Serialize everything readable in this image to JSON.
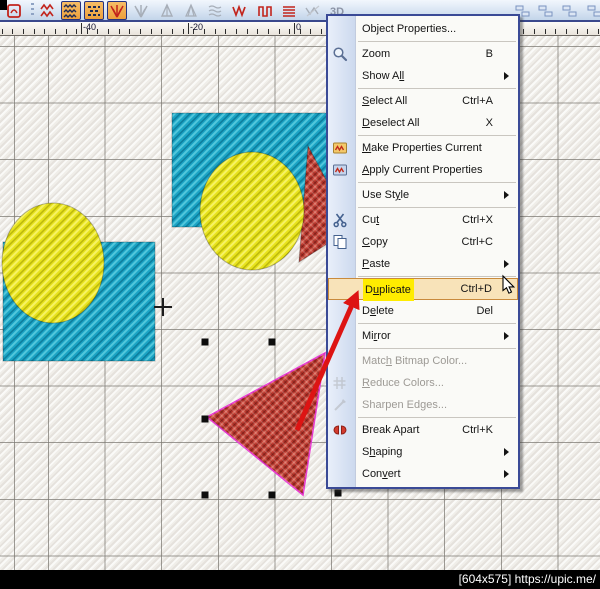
{
  "window": {
    "watermark": "[604x575] https://upic.me/"
  },
  "toolbar": {
    "icons": [
      {
        "name": "motif-stamp-icon",
        "glyph": "motif",
        "x": 4,
        "pressed": false,
        "disabled": false
      },
      {
        "name": "toolbar-separator",
        "glyph": "sep",
        "x": 31
      },
      {
        "name": "stitch-zigzag-icon",
        "glyph": "zzred",
        "x": 38,
        "pressed": false,
        "disabled": false
      },
      {
        "name": "tatami-fill-icon",
        "glyph": "tatami",
        "x": 61,
        "pressed": true,
        "disabled": false
      },
      {
        "name": "motif-fill-icon",
        "glyph": "dots",
        "x": 84,
        "pressed": true,
        "disabled": false
      },
      {
        "name": "fancy-fill-icon",
        "glyph": "burstred",
        "x": 107,
        "pressed": true,
        "disabled": false
      },
      {
        "name": "radial-fill-icon",
        "glyph": "burstgray",
        "x": 131,
        "pressed": false,
        "disabled": true
      },
      {
        "name": "fur-effect-icon",
        "glyph": "tree",
        "x": 157,
        "pressed": false,
        "disabled": true
      },
      {
        "name": "feather-edge-icon",
        "glyph": "tree2",
        "x": 181,
        "pressed": false,
        "disabled": true
      },
      {
        "name": "ripple-effect-icon",
        "glyph": "ripple",
        "x": 205,
        "pressed": false,
        "disabled": true
      },
      {
        "name": "zigzag-stitch-icon",
        "glyph": "zzw",
        "x": 230,
        "pressed": false,
        "disabled": false
      },
      {
        "name": "step-stitch-icon",
        "glyph": "pipe",
        "x": 255,
        "pressed": false,
        "disabled": false
      },
      {
        "name": "satin-stitch-icon",
        "glyph": "lines",
        "x": 279,
        "pressed": false,
        "disabled": false
      },
      {
        "name": "texture-hatch-icon",
        "glyph": "hatch",
        "x": 303,
        "pressed": false,
        "disabled": true
      },
      {
        "name": "3d-effect-button",
        "glyph": "text3d",
        "x": 327,
        "pressed": false,
        "disabled": true,
        "label": "3D"
      },
      {
        "name": "align-tool-icon",
        "glyph": "align",
        "x": 513,
        "pressed": false,
        "disabled": false
      },
      {
        "name": "distribute-tool-icon",
        "glyph": "align",
        "x": 536,
        "pressed": false,
        "disabled": false
      },
      {
        "name": "spacing-tool-icon",
        "glyph": "align",
        "x": 560,
        "pressed": false,
        "disabled": false
      },
      {
        "name": "group-tool-icon",
        "glyph": "align",
        "x": 585,
        "pressed": false,
        "disabled": false
      }
    ]
  },
  "ruler": {
    "labels": [
      {
        "text": "-40",
        "x": 83
      },
      {
        "text": "-20",
        "x": 190
      },
      {
        "text": "0",
        "x": 296
      }
    ],
    "major_tick_x": [
      81,
      187.6,
      294.2,
      400.8,
      507.4
    ],
    "minor_step": 10.65
  },
  "context_menu": {
    "items": [
      {
        "label": "Object Properties...",
        "mnemonic": -1,
        "mlen": 1,
        "shortcut": "",
        "icon": null,
        "submenu": false,
        "disabled": false,
        "highlighted": false,
        "marked": false
      },
      {
        "type": "separator"
      },
      {
        "label": "Zoom",
        "mnemonic": -1,
        "mlen": 1,
        "shortcut": "B",
        "icon": "zoom",
        "submenu": false,
        "disabled": false,
        "highlighted": false,
        "marked": false
      },
      {
        "label": "Show All",
        "mnemonic": 6,
        "mlen": 2,
        "shortcut": "",
        "icon": null,
        "submenu": true,
        "disabled": false,
        "highlighted": false,
        "marked": false
      },
      {
        "type": "separator"
      },
      {
        "label": "Select All",
        "mnemonic": 0,
        "mlen": 1,
        "shortcut": "Ctrl+A",
        "icon": null,
        "submenu": false,
        "disabled": false,
        "highlighted": false,
        "marked": false
      },
      {
        "label": "Deselect All",
        "mnemonic": 0,
        "mlen": 1,
        "shortcut": "X",
        "icon": null,
        "submenu": false,
        "disabled": false,
        "highlighted": false,
        "marked": false
      },
      {
        "type": "separator"
      },
      {
        "label": "Make Properties Current",
        "mnemonic": 0,
        "mlen": 1,
        "shortcut": "",
        "icon": "make-props",
        "submenu": false,
        "disabled": false,
        "highlighted": false,
        "marked": false
      },
      {
        "label": "Apply Current Properties",
        "mnemonic": 0,
        "mlen": 1,
        "shortcut": "",
        "icon": "apply-props",
        "submenu": false,
        "disabled": false,
        "highlighted": false,
        "marked": false
      },
      {
        "type": "separator"
      },
      {
        "label": "Use Style",
        "mnemonic": 6,
        "mlen": 1,
        "shortcut": "",
        "icon": null,
        "submenu": true,
        "disabled": false,
        "highlighted": false,
        "marked": false
      },
      {
        "type": "separator"
      },
      {
        "label": "Cut",
        "mnemonic": 2,
        "mlen": 1,
        "shortcut": "Ctrl+X",
        "icon": "cut",
        "submenu": false,
        "disabled": false,
        "highlighted": false,
        "marked": false
      },
      {
        "label": "Copy",
        "mnemonic": 0,
        "mlen": 1,
        "shortcut": "Ctrl+C",
        "icon": "copy",
        "submenu": false,
        "disabled": false,
        "highlighted": false,
        "marked": false
      },
      {
        "label": "Paste",
        "mnemonic": 0,
        "mlen": 1,
        "shortcut": "",
        "icon": null,
        "submenu": true,
        "disabled": false,
        "highlighted": false,
        "marked": false
      },
      {
        "type": "separator"
      },
      {
        "label": "Duplicate",
        "mnemonic": 1,
        "mlen": 1,
        "shortcut": "Ctrl+D",
        "icon": null,
        "submenu": false,
        "disabled": false,
        "highlighted": true,
        "marked": true
      },
      {
        "label": "Delete",
        "mnemonic": 1,
        "mlen": 1,
        "shortcut": "Del",
        "icon": null,
        "submenu": false,
        "disabled": false,
        "highlighted": false,
        "marked": false
      },
      {
        "type": "separator"
      },
      {
        "label": "Mirror",
        "mnemonic": 2,
        "mlen": 1,
        "shortcut": "",
        "icon": null,
        "submenu": true,
        "disabled": false,
        "highlighted": false,
        "marked": false
      },
      {
        "type": "separator"
      },
      {
        "label": "Match Bitmap Color...",
        "mnemonic": 4,
        "mlen": 1,
        "shortcut": "",
        "icon": null,
        "submenu": false,
        "disabled": true,
        "highlighted": false,
        "marked": false
      },
      {
        "label": "Reduce Colors...",
        "mnemonic": 0,
        "mlen": 1,
        "shortcut": "",
        "icon": "reduce",
        "submenu": false,
        "disabled": true,
        "highlighted": false,
        "marked": false
      },
      {
        "label": "Sharpen Edges...",
        "mnemonic": -1,
        "mlen": 1,
        "shortcut": "",
        "icon": "sharpen",
        "submenu": false,
        "disabled": true,
        "highlighted": false,
        "marked": false
      },
      {
        "type": "separator"
      },
      {
        "label": "Break Apart",
        "mnemonic": -1,
        "mlen": 1,
        "shortcut": "Ctrl+K",
        "icon": "break-apart",
        "submenu": false,
        "disabled": false,
        "highlighted": false,
        "marked": false
      },
      {
        "label": "Shaping",
        "mnemonic": 1,
        "mlen": 1,
        "shortcut": "",
        "icon": null,
        "submenu": true,
        "disabled": false,
        "highlighted": false,
        "marked": false
      },
      {
        "label": "Convert",
        "mnemonic": 3,
        "mlen": 1,
        "shortcut": "",
        "icon": null,
        "submenu": true,
        "disabled": false,
        "highlighted": false,
        "marked": false
      }
    ]
  },
  "canvas": {
    "objects": [
      {
        "id": "rectangle-top",
        "type": "rectangle",
        "fill": "teal",
        "x": 172,
        "y": 113,
        "w": 163,
        "h": 114
      },
      {
        "id": "triangle-top",
        "type": "triangle",
        "fill": "red",
        "points": [
          [
            308,
            146
          ],
          [
            352,
            228
          ],
          [
            299,
            262
          ]
        ]
      },
      {
        "id": "circle-top",
        "type": "ellipse",
        "fill": "yellow",
        "cx": 252,
        "cy": 211,
        "rx": 52,
        "ry": 59
      },
      {
        "id": "rectangle-left",
        "type": "rectangle",
        "fill": "teal",
        "x": 3,
        "y": 242,
        "w": 152,
        "h": 119
      },
      {
        "id": "circle-left",
        "type": "ellipse",
        "fill": "yellow",
        "cx": 53,
        "cy": 263,
        "rx": 51,
        "ry": 60
      },
      {
        "id": "triangle-selected",
        "type": "triangle",
        "fill": "red",
        "selected": true,
        "points": [
          [
            325,
            353
          ],
          [
            207,
            417
          ],
          [
            303,
            495
          ]
        ]
      }
    ],
    "selection_handles": [
      [
        205,
        342
      ],
      [
        272,
        342
      ],
      [
        205,
        419
      ],
      [
        205,
        495
      ],
      [
        272,
        495
      ],
      [
        338,
        493
      ]
    ],
    "crosshair": {
      "x": 163,
      "y": 307
    },
    "annotation_arrow": {
      "from": [
        297,
        430
      ],
      "to": [
        352,
        305
      ]
    },
    "pointer_cursor": {
      "x": 503,
      "y": 276
    }
  },
  "colors": {
    "teal": "#1ba4c5",
    "teal_light": "#52c7db",
    "teal_dark": "#0d7e9d",
    "yellow": "#e8e31d",
    "yellow_light": "#f6f266",
    "yellow_dark": "#bdb90c",
    "red": "#c0392f",
    "red_light": "#d96b5c",
    "red_dark": "#8f241c",
    "selection_outline": "#e83bd0",
    "arrow_red": "#dd1413",
    "highlight_yellow": "#ffec00",
    "menu_hover_bg": "#f8e3b9",
    "menu_hover_border": "#c98a3c",
    "grid_line": "#7d7a74"
  }
}
